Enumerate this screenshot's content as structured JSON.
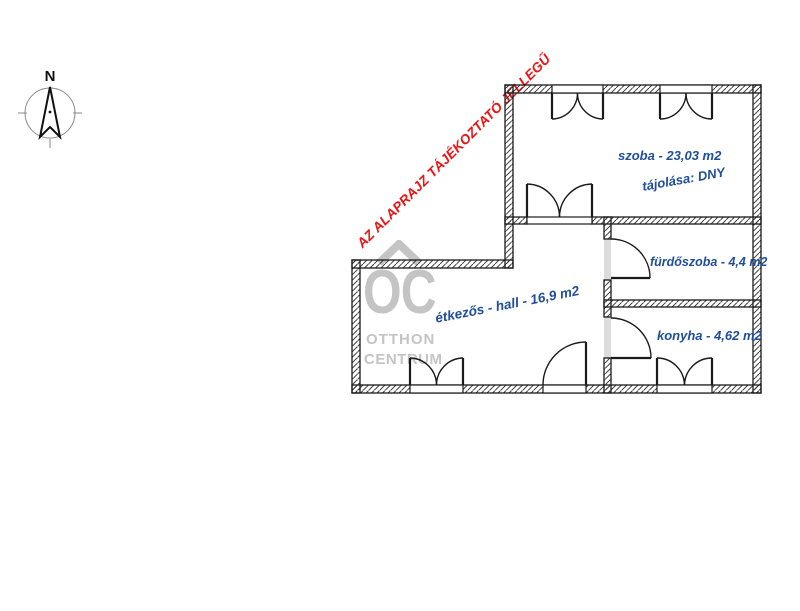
{
  "compass": {
    "north_label": "N"
  },
  "warning": {
    "text": "AZ ALAPRAJZ TÁJÉKOZTATÓ JELLEGŰ"
  },
  "watermark": {
    "monogram": "OC",
    "line1": "OTTHON",
    "line2": "CENTRUM"
  },
  "rooms": [
    {
      "name": "szoba",
      "label": "szoba - 23,03 m2",
      "orientation_note": "tájolása: DNY",
      "area_m2": "23,03"
    },
    {
      "name": "fürdőszoba",
      "label": "fürdőszoba - 4,4 m2",
      "area_m2": "4,4"
    },
    {
      "name": "konyha",
      "label": "konyha - 4,62 m2",
      "area_m2": "4,62"
    },
    {
      "name": "étkezős - hall",
      "label": "étkezős - hall - 16,9 m2",
      "area_m2": "16,9"
    }
  ],
  "colors": {
    "label_blue": "#1F4E9B",
    "warning_red": "#EE1111",
    "watermark_gray": "#C4C4C4",
    "wall_black": "#1A1A1A"
  }
}
